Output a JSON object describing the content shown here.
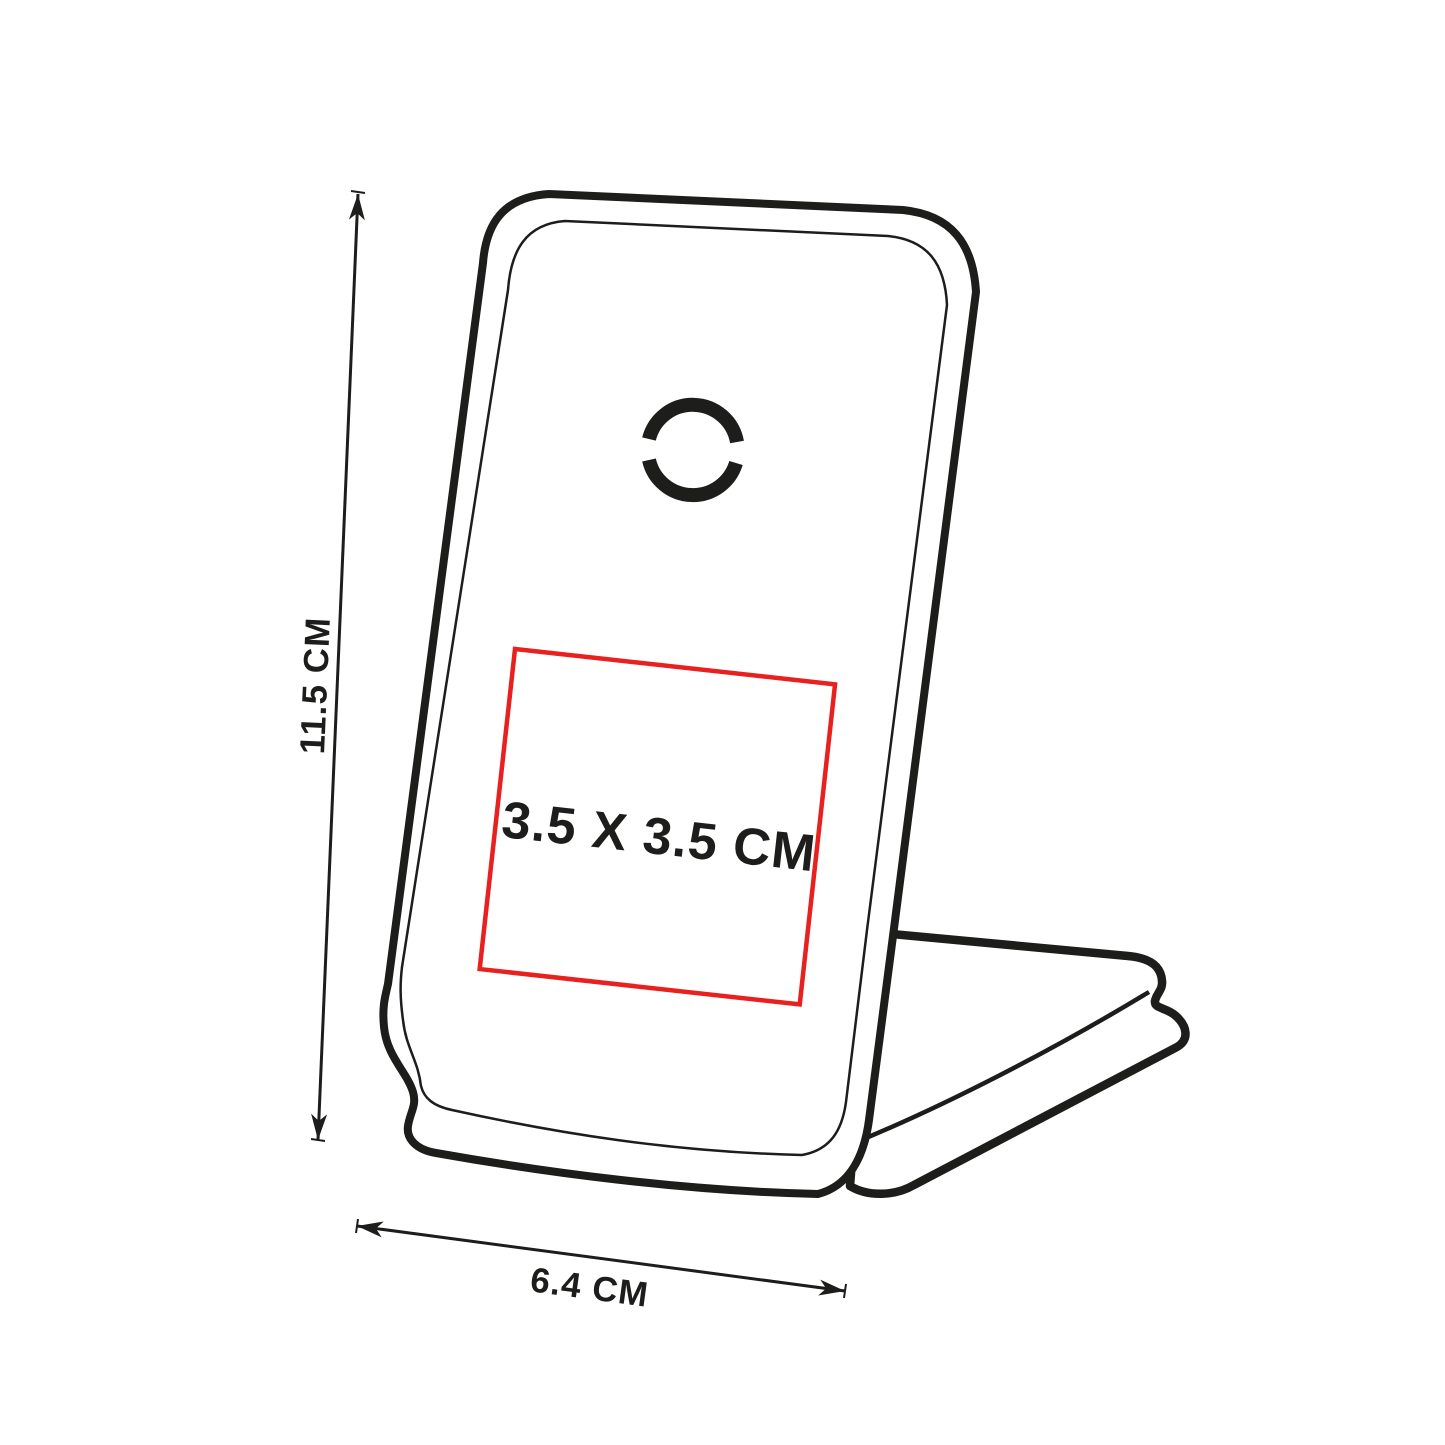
{
  "diagram": {
    "name": "phone-stand-dimension-diagram",
    "product": "folding wireless charger phone stand (line drawing)",
    "dimensions": {
      "height_label": "11.5 CM",
      "width_label": "6.4 CM",
      "print_area_label": "3.5 X 3.5 CM"
    },
    "icons": {
      "charging_pad": "wireless-charging-circle-icon"
    },
    "colors": {
      "outline": "#1d1d1b",
      "print_area_border": "#e8201e",
      "background": "#ffffff"
    }
  }
}
